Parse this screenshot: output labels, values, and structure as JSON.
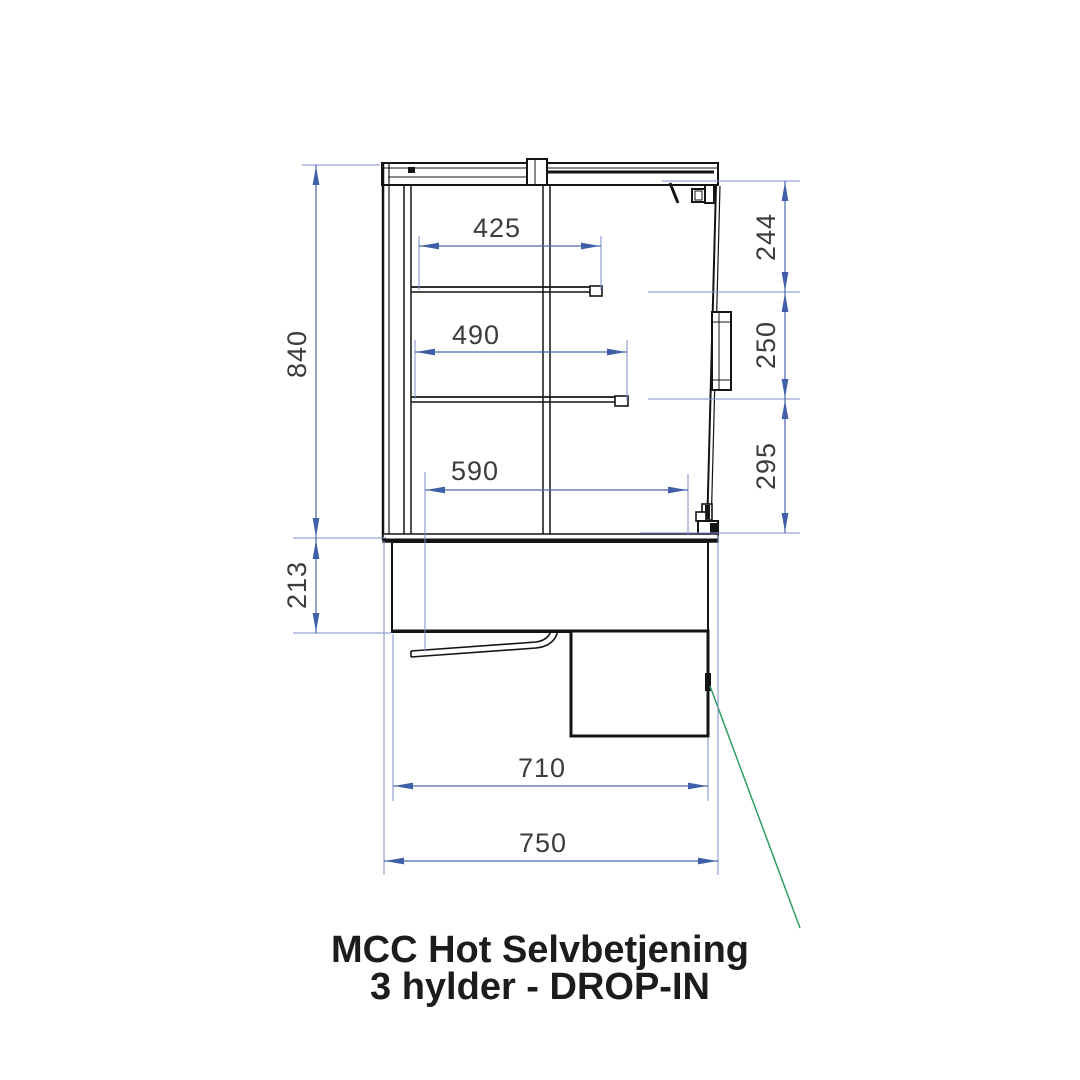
{
  "drawing": {
    "kind": "technical-side-view",
    "title": {
      "line1": "MCC Hot Selvbetjening",
      "line2": "3 hylder - DROP-IN"
    },
    "dimensions_mm": {
      "overall_height": "840",
      "base_height": "213",
      "top_shelf_depth": "425",
      "middle_shelf_depth": "490",
      "bottom_shelf_depth": "590",
      "top_section_height": "244",
      "middle_section_height": "250",
      "bottom_section_height": "295",
      "body_depth": "710",
      "overall_depth": "750"
    },
    "colors": {
      "dimension_lines": "#4a67ae",
      "extension_lines": "#7b8ec8",
      "dimension_arrows": "#3f5fa8",
      "dimension_text": "#3c3c3c",
      "drawing_lines": "#141414",
      "leader_line": "#2f9e63",
      "title_text": "#1c1c1c",
      "background": "#ffffff"
    }
  }
}
